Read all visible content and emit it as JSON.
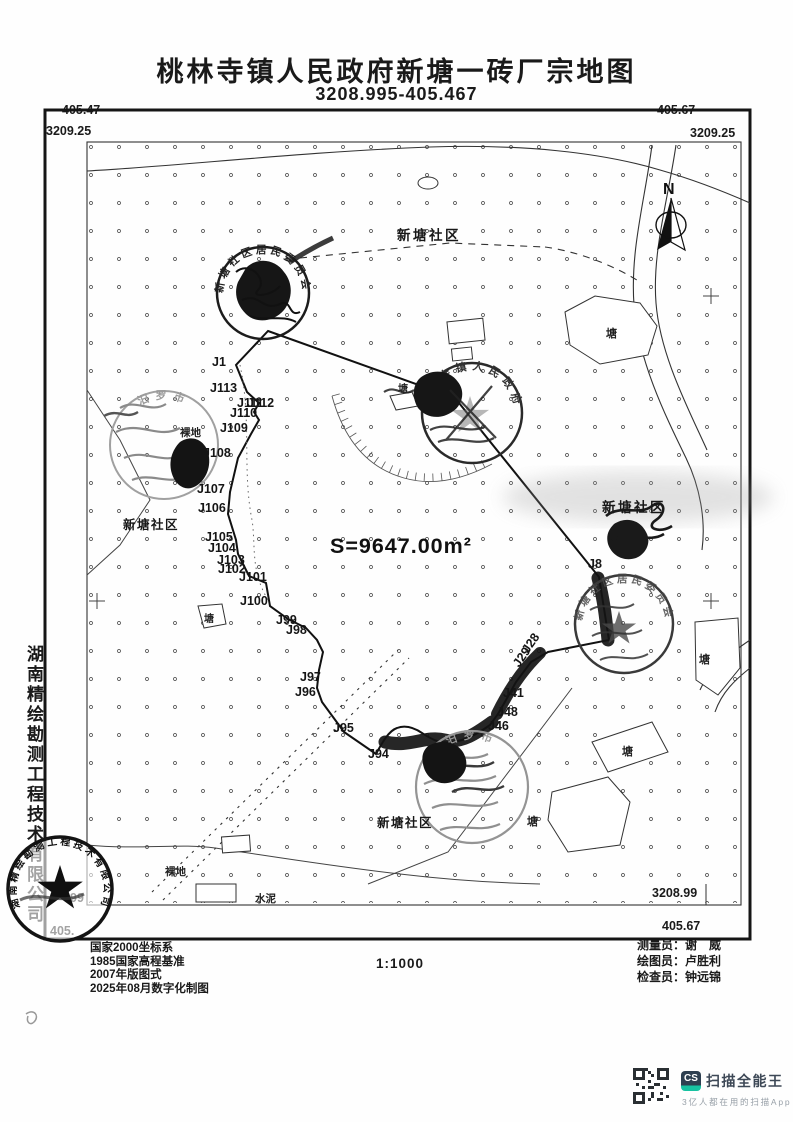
{
  "page": {
    "title": "桃林寺镇人民政府新塘一砖厂宗地图",
    "subtitle": "3208.995-405.467"
  },
  "frame_coords": {
    "top_left_e": "405.47",
    "top_left_n": "3209.25",
    "top_right_e": "405.67",
    "top_right_n": "3209.25",
    "bottom_right_n": "3208.99",
    "bottom_right_e": "405.67",
    "bottom_left_n_partial": "99",
    "bottom_left_e_partial": "405."
  },
  "company_side_text": "湖南精绘勘测工程技术有限公司",
  "map": {
    "labels": [
      {
        "t": "新塘社区",
        "x": 397,
        "y": 240,
        "cls": "community"
      },
      {
        "t": "新塘社区",
        "x": 123,
        "y": 529,
        "cls": "community-sm"
      },
      {
        "t": "新塘社区",
        "x": 602,
        "y": 512,
        "cls": "community"
      },
      {
        "t": "新塘社区",
        "x": 377,
        "y": 827,
        "cls": "community-sm"
      },
      {
        "t": "塘",
        "x": 606,
        "y": 337,
        "cls": "pond"
      },
      {
        "t": "塘",
        "x": 398,
        "y": 392,
        "cls": "pond-sm"
      },
      {
        "t": "塘",
        "x": 204,
        "y": 622,
        "cls": "pond-sm"
      },
      {
        "t": "塘",
        "x": 699,
        "y": 663,
        "cls": "pond"
      },
      {
        "t": "塘",
        "x": 622,
        "y": 755,
        "cls": "pond"
      },
      {
        "t": "塘",
        "x": 527,
        "y": 825,
        "cls": "pond"
      },
      {
        "t": "裸地",
        "x": 180,
        "y": 436,
        "cls": "ground"
      },
      {
        "t": "裸地",
        "x": 165,
        "y": 875,
        "cls": "ground"
      },
      {
        "t": "水泥",
        "x": 255,
        "y": 902,
        "cls": "ground"
      },
      {
        "t": "S=9647.00m²",
        "x": 330,
        "y": 553,
        "cls": "arealabel"
      },
      {
        "t": "N",
        "x": 663,
        "y": 194,
        "cls": "north"
      }
    ],
    "points": [
      {
        "t": "J1",
        "x": 212,
        "y": 366
      },
      {
        "t": "J113",
        "x": 210,
        "y": 392
      },
      {
        "t": "J111",
        "x": 237,
        "y": 407
      },
      {
        "t": "J112",
        "x": 247,
        "y": 407
      },
      {
        "t": "J110",
        "x": 230,
        "y": 417
      },
      {
        "t": "J109",
        "x": 220,
        "y": 432
      },
      {
        "t": "J108",
        "x": 203,
        "y": 457
      },
      {
        "t": "J107",
        "x": 197,
        "y": 493
      },
      {
        "t": "J106",
        "x": 198,
        "y": 512
      },
      {
        "t": "J105",
        "x": 205,
        "y": 541
      },
      {
        "t": "J104",
        "x": 208,
        "y": 552
      },
      {
        "t": "J103",
        "x": 217,
        "y": 564
      },
      {
        "t": "J102",
        "x": 218,
        "y": 573
      },
      {
        "t": "J101",
        "x": 239,
        "y": 581
      },
      {
        "t": "J100",
        "x": 240,
        "y": 605
      },
      {
        "t": "J99",
        "x": 276,
        "y": 624
      },
      {
        "t": "J98",
        "x": 286,
        "y": 634
      },
      {
        "t": "J97",
        "x": 300,
        "y": 681
      },
      {
        "t": "J96",
        "x": 295,
        "y": 696
      },
      {
        "t": "J95",
        "x": 333,
        "y": 732
      },
      {
        "t": "J94",
        "x": 368,
        "y": 758
      },
      {
        "t": "J46",
        "x": 488,
        "y": 730
      },
      {
        "t": "J48",
        "x": 497,
        "y": 716
      },
      {
        "t": "J41",
        "x": 503,
        "y": 697
      },
      {
        "t": "J29",
        "x": 519,
        "y": 668,
        "rot": -55
      },
      {
        "t": "J28",
        "x": 528,
        "y": 654,
        "rot": -55
      },
      {
        "t": "J8",
        "x": 588,
        "y": 568
      }
    ]
  },
  "stamps": [
    {
      "id": "top",
      "text": "新塘社区居民委员会"
    },
    {
      "id": "middle",
      "text": "桃林寺镇人民政府"
    },
    {
      "id": "left",
      "text": "汨罗市"
    },
    {
      "id": "right",
      "text": "新塘社区居民委员会"
    },
    {
      "id": "bottom",
      "text": "汨罗市"
    },
    {
      "id": "corner",
      "text": "湖南精绘勘测工程技术有限公司"
    }
  ],
  "footer": {
    "notes": [
      "国家2000坐标系",
      "1985国家高程基准",
      "2007年版图式",
      "2025年08月数字化制图"
    ],
    "scale": "1:1000",
    "credits": [
      {
        "role": "测量员：",
        "name": "谢　威"
      },
      {
        "role": "绘图员：",
        "name": "卢胜利"
      },
      {
        "role": "检查员：",
        "name": "钟远锦"
      }
    ]
  },
  "scanner": {
    "logo": "CS",
    "name": "扫描全能王",
    "tagline": "3亿人都在用的扫描App"
  }
}
